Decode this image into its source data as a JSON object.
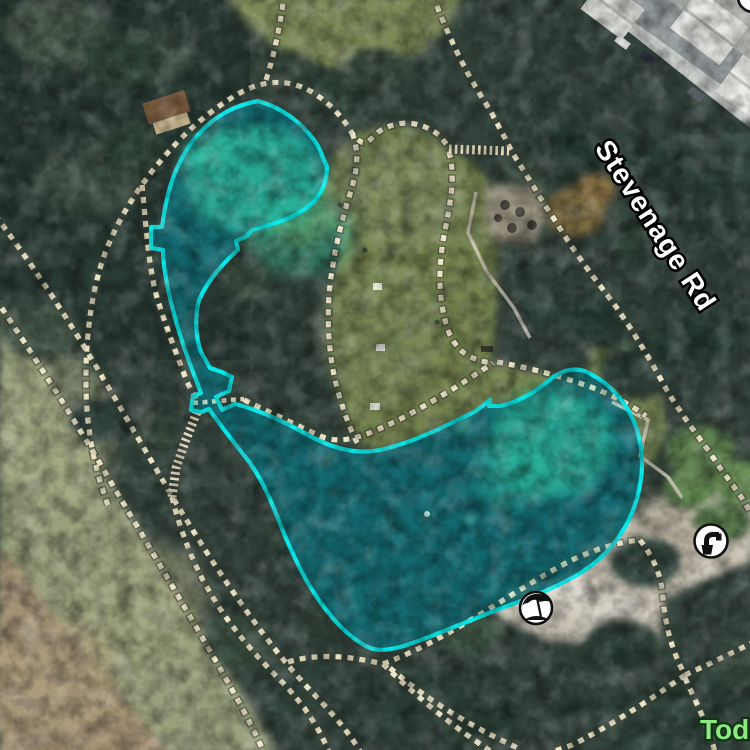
{
  "map": {
    "labels": {
      "road": {
        "text": "Stevenage Rd",
        "color": "#ffffff",
        "halo": "#000000"
      },
      "poi": {
        "text": "Todd",
        "color": "#8be97e",
        "halo": "#14321a"
      }
    },
    "icons": [
      {
        "name": "drinking-water-icon"
      },
      {
        "name": "beach-umbrella-icon"
      },
      {
        "name": "partial-poi-icon-top-right"
      }
    ],
    "selection": {
      "feature": "pond",
      "stroke": "#0ae8e8",
      "fill_rgba": "rgba(10,232,232,0.16)"
    },
    "path_style": {
      "dash": "#ede5c5",
      "casing": "#3e443a"
    }
  }
}
